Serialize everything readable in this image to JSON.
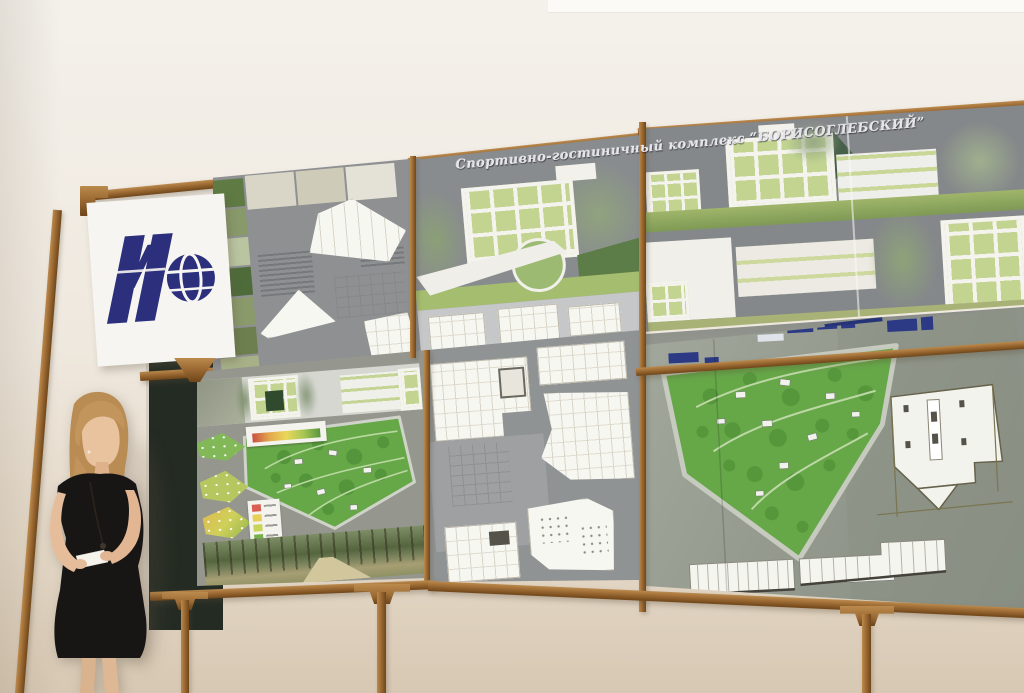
{
  "scene": {
    "description": "presentation of architectural competition boards",
    "title_text": "Спортивно-гостиничный комплекс “БОРИСОГЛЕБСКИЙ”"
  },
  "colors": {
    "wall_top": "#f4f1eb",
    "wall_mid": "#efe8de",
    "wall_low": "#e5d9c8",
    "wall_bottom": "#d7c8b3",
    "wood_light": "#bb8a4d",
    "wood": "#9c6a33",
    "wood_dark": "#6f4619",
    "board_sky": "#898c8e",
    "board_gray": "#909394",
    "aerial_gray": "#9aa094",
    "park_green": "#66a748",
    "park_green_dark": "#4c8a33",
    "glass_green": "#c2d490",
    "lawn_green": "#a5bd6f",
    "hedge_green": "#5d7d48",
    "logo_blue": "#2b2f7c",
    "navy_building": "#2c3a86",
    "chalkboard_green": "#242b23",
    "banner_white": "#f7f5f1",
    "skin": "#e9c29e",
    "hair_blonde": "#c1955c",
    "dress_black": "#171615",
    "title_color": "#e6e6ea"
  }
}
